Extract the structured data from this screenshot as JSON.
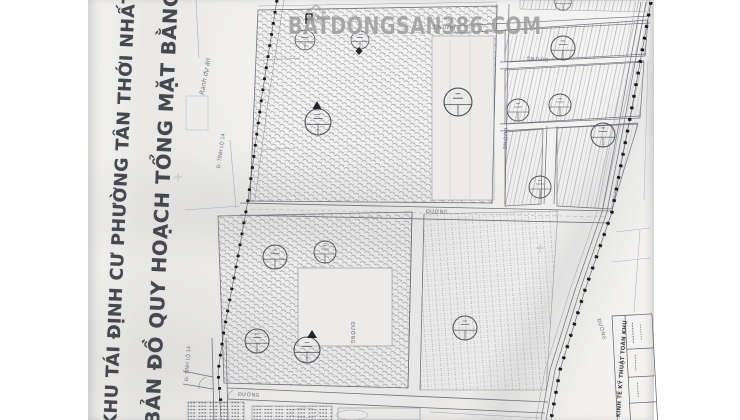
{
  "watermark": {
    "text": "BATDONGSAN386.COM",
    "icon": "house-outline-icon",
    "color": "#8f8f8d"
  },
  "title": {
    "line1": "KHU TÁI ĐỊNH CƯ PHƯỜNG TÂN THỚI NHẤT ( KH",
    "line2": "BẢN ĐỒ QUY HOẠCH TỔNG MẶT BẰNG SỬ"
  },
  "labels": {
    "boundary": "Ranh dự án",
    "provincial_road": "Đ. TỈNH LỘ 14",
    "road": "ĐƯỜNG",
    "table_header": "KINH TẾ KỸ THUẬT TOÀN KHU"
  },
  "colors": {
    "paper": "#edecea",
    "line": "#7a7e88",
    "line_dark": "#4c4f57",
    "hatch": "#8d919b",
    "boundary_dot": "#1a1a1d",
    "watermark": "#8f8f8d",
    "title_text": "#45484e"
  }
}
